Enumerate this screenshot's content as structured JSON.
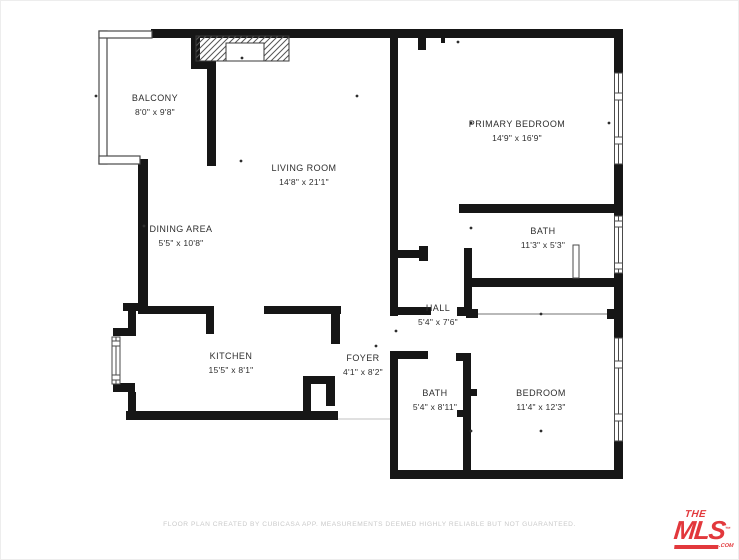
{
  "plan": {
    "wall_color": "#161616",
    "rooms": {
      "balcony": {
        "name": "BALCONY",
        "dims": "8'0\" x 9'8\""
      },
      "living_room": {
        "name": "LIVING ROOM",
        "dims": "14'8\" x 21'1\""
      },
      "dining_area": {
        "name": "DINING AREA",
        "dims": "5'5\" x 10'8\""
      },
      "kitchen": {
        "name": "KITCHEN",
        "dims": "15'5\" x 8'1\""
      },
      "foyer": {
        "name": "FOYER",
        "dims": "4'1\" x 8'2\""
      },
      "hall": {
        "name": "HALL",
        "dims": "5'4\" x 7'6\""
      },
      "primary_bedroom": {
        "name": "PRIMARY BEDROOM",
        "dims": "14'9\" x 16'9\""
      },
      "bath_upper": {
        "name": "BATH",
        "dims": "11'3\" x 5'3\""
      },
      "bath_lower": {
        "name": "BATH",
        "dims": "5'4\" x 8'11\""
      },
      "bedroom": {
        "name": "BEDROOM",
        "dims": "11'4\" x 12'3\""
      }
    }
  },
  "footer": {
    "text": "FLOOR PLAN CREATED BY CUBICASA APP. MEASUREMENTS DEEMED HIGHLY RELIABLE BUT NOT GUARANTEED."
  },
  "logo": {
    "line1": "THE",
    "line2": "MLS",
    "tm": "™",
    "suffix": ".COM",
    "color": "#e2383c"
  }
}
